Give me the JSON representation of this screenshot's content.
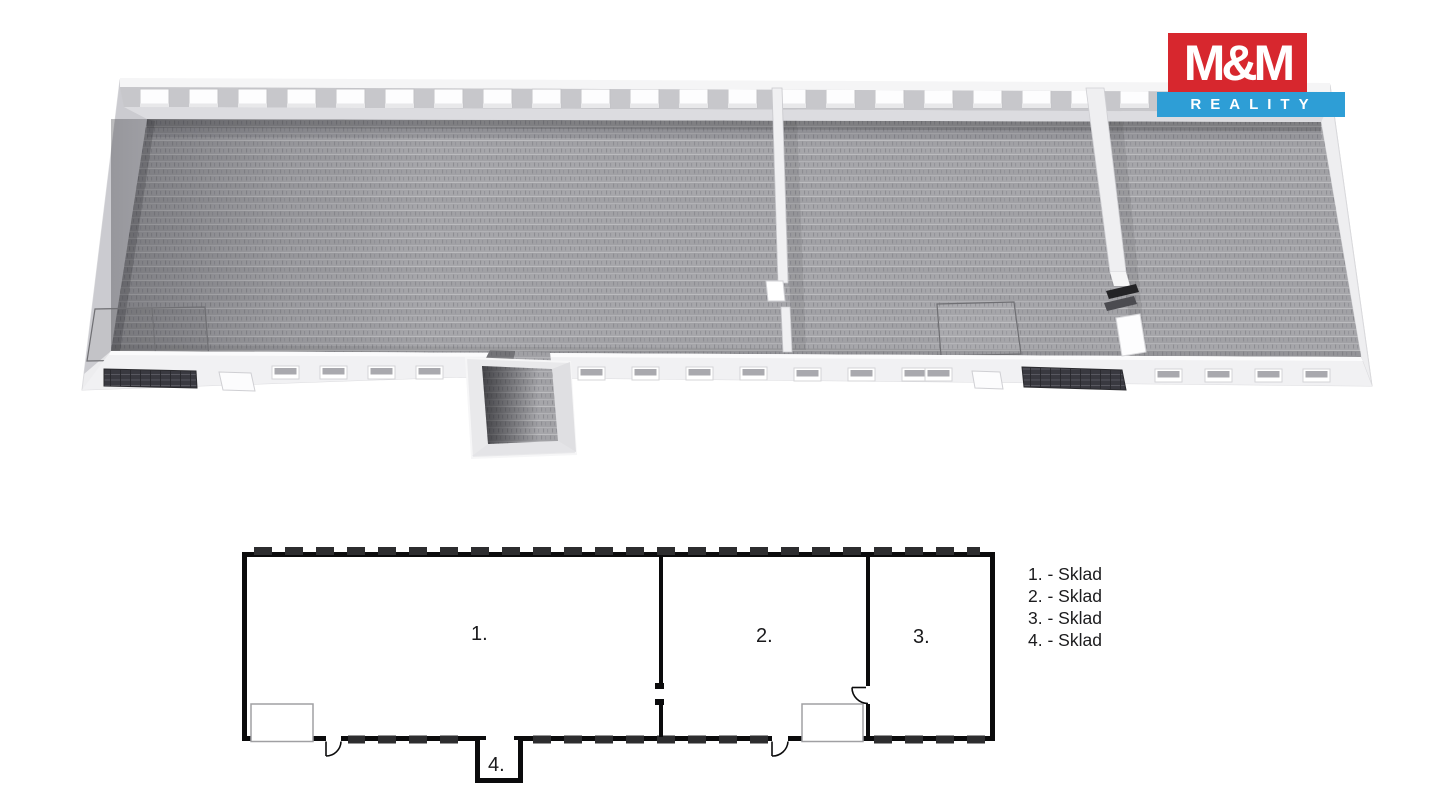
{
  "logo": {
    "title": "M&M",
    "subtitle": "REALITY",
    "red": "#d7272e",
    "blue": "#2e9ed6"
  },
  "plan2d": {
    "room_labels": [
      "1.",
      "2.",
      "3.",
      "4."
    ],
    "line_color": "#0b0b0c"
  },
  "legend": {
    "items": [
      "1. - Sklad",
      "2. - Sklad",
      "3. - Sklad",
      "4. - Sklad"
    ]
  },
  "render3d": {
    "floor_color": "#a3a3a7",
    "wall_color": "#ededef"
  }
}
